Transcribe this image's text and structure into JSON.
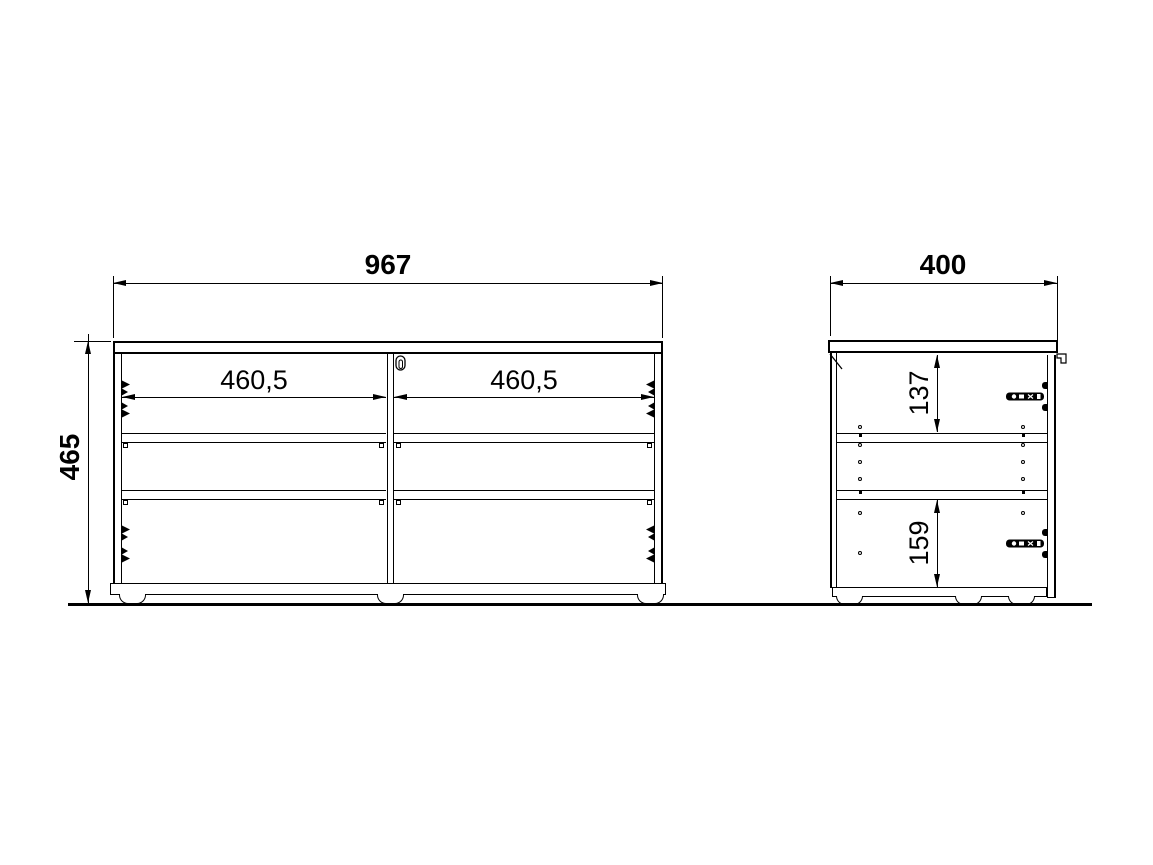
{
  "front_view": {
    "width_label": "967",
    "height_label": "465",
    "left_opening_label": "460,5",
    "right_opening_label": "460,5"
  },
  "side_view": {
    "depth_label": "400",
    "top_clearance_label": "137",
    "bottom_clearance_label": "159"
  },
  "colors": {
    "line": "#000000",
    "bg": "#ffffff"
  }
}
